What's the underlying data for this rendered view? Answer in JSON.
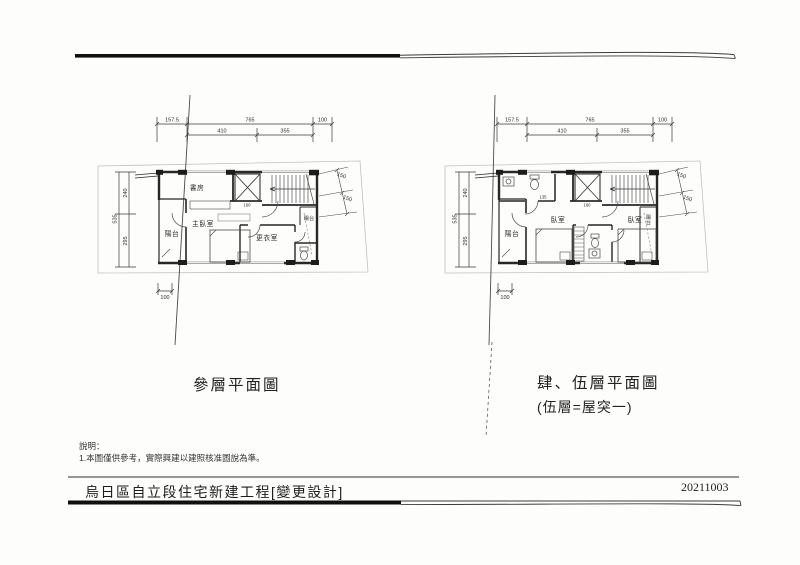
{
  "document": {
    "footer": {
      "project_title": "烏日區自立段住宅新建工程[變更設計]",
      "date": "20211003"
    },
    "notes": {
      "heading": "說明：",
      "item1": "1.本圖僅供參考，實際興建以建照核准圖說為準。"
    }
  },
  "plans": [
    {
      "caption": "參層平面圖",
      "dims": {
        "top_row1": [
          "157.5",
          "765",
          "100"
        ],
        "top_row2": [
          "410",
          "355"
        ],
        "left_total": "535",
        "left_top": "240",
        "left_bottom": "295",
        "bottom": "100",
        "right_upper": "150",
        "right_lower": "150",
        "elevator": "160"
      },
      "rooms": {
        "study": "書房",
        "master_bedroom": "主臥室",
        "closet": "更衣室",
        "balcony_left": "陽台",
        "balcony_right": "陽台"
      }
    },
    {
      "caption": "肆、伍層平面圖",
      "caption_sub": "(伍層=屋突一)",
      "dims": {
        "top_row1": [
          "157.5",
          "765",
          "100"
        ],
        "top_row2": [
          "410",
          "355"
        ],
        "left_total": "535",
        "left_top": "240",
        "left_bottom": "295",
        "bottom": "100",
        "right_upper": "150",
        "right_lower": "150",
        "elevator": "160",
        "bathroom": "135"
      },
      "rooms": {
        "bedroom_left": "臥室",
        "bedroom_right": "臥室",
        "balcony_left": "陽台",
        "balcony_right": "陽台"
      }
    }
  ]
}
